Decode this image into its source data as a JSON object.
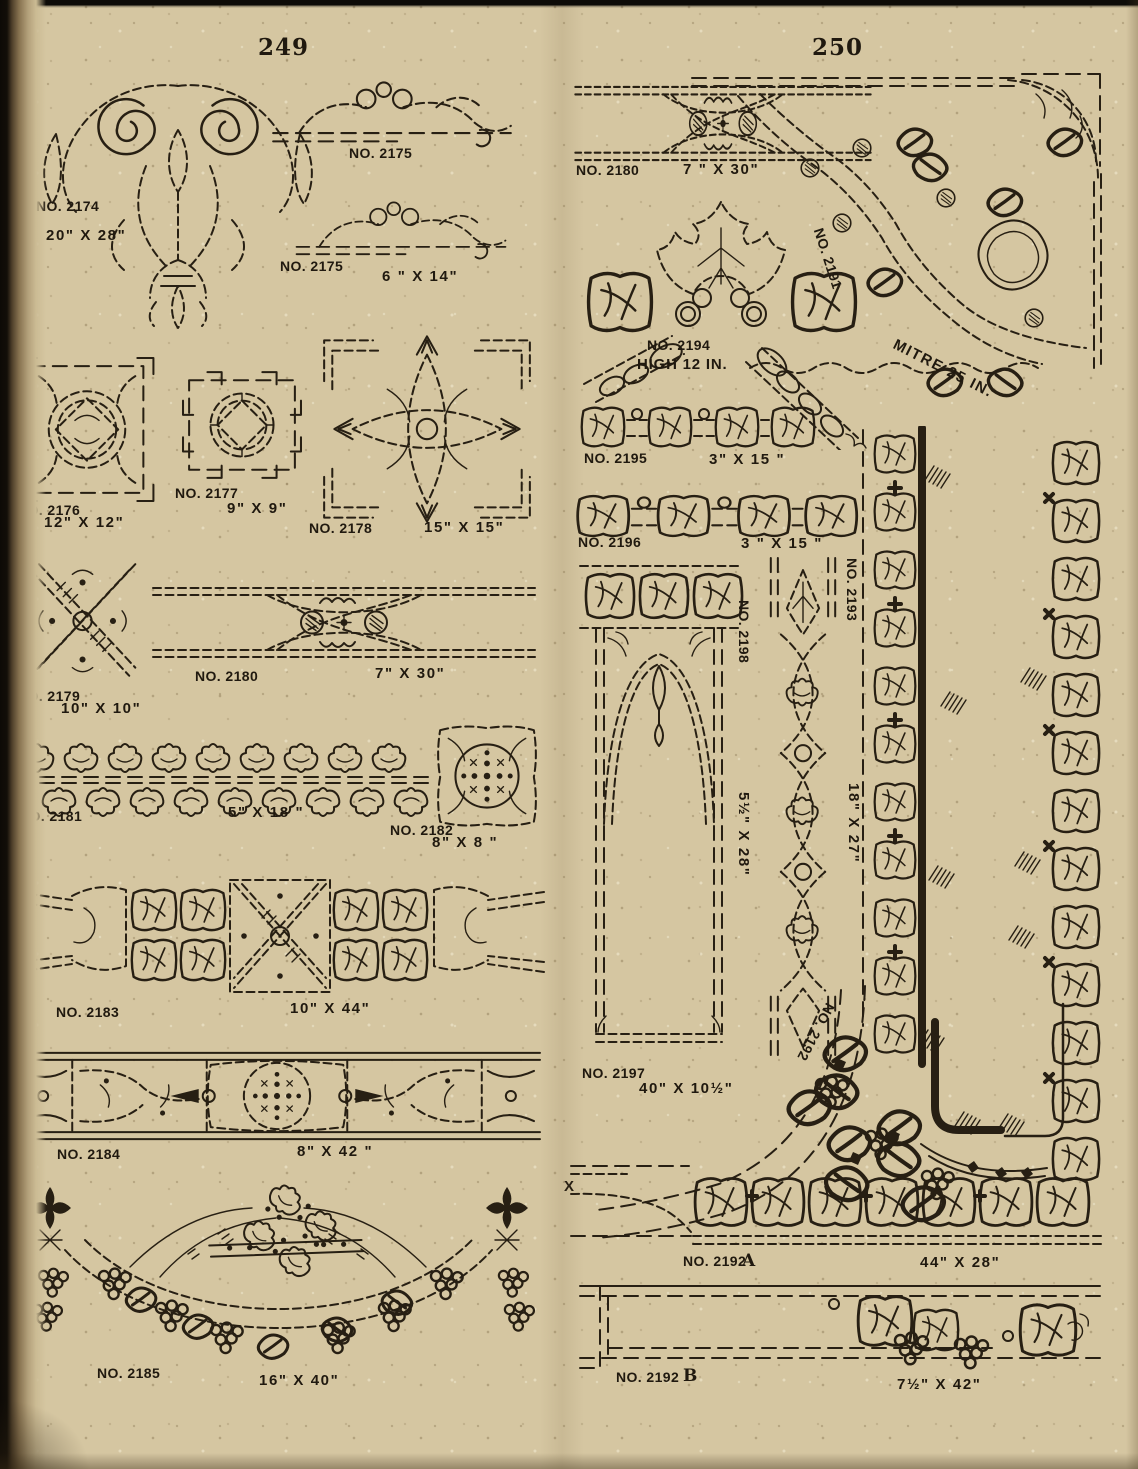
{
  "document": {
    "left_page_number": "249",
    "right_page_number": "250"
  },
  "colors": {
    "paper": "#d5c6a1",
    "ink": "#271f13"
  },
  "left_items": {
    "i2174": {
      "no": "NO. 2174",
      "size": "20\" X 28\""
    },
    "i2175a": {
      "no": "NO. 2175"
    },
    "i2175b": {
      "no": "NO. 2175",
      "size": "6 \" X 14\""
    },
    "i2176": {
      "no": "NO. 2176",
      "size": "12\" X 12\""
    },
    "i2177": {
      "no": "NO. 2177",
      "size": "9\" X  9\""
    },
    "i2178": {
      "no": "NO. 2178",
      "size": "15\" X  15\""
    },
    "i2179": {
      "no": "NO. 2179",
      "size": "10\" X 10\""
    },
    "i2180": {
      "no": "NO. 2180",
      "size": "7\" X 30\""
    },
    "i2181": {
      "no": "NO. 2181",
      "size": "5\" X 18 \""
    },
    "i2182": {
      "no": "NO. 2182",
      "size": "8\" X  8 \""
    },
    "i2183": {
      "no": "NO. 2183",
      "size": "10\" X 44\""
    },
    "i2184": {
      "no": "NO. 2184",
      "size": "8\" X 42 \""
    },
    "i2185": {
      "no": "NO. 2185",
      "size": "16\" X 40\""
    }
  },
  "right_items": {
    "i2180": {
      "no": "NO. 2180",
      "size": "7 \" X 30\""
    },
    "i2191": {
      "no": "NO. 2191",
      "size": "MITRE  25 IN."
    },
    "i2194": {
      "no": "NO. 2194",
      "size": "HIGH 12 IN."
    },
    "i2195": {
      "no": "NO. 2195",
      "size": "3\" X  15 \""
    },
    "i2196": {
      "no": "NO. 2196",
      "size": "3 \" X  15 \""
    },
    "i2197": {
      "no": "NO. 2197",
      "size": "40\" X 10½\""
    },
    "i2198": {
      "no": "NO. 2198",
      "size": "5½\" X 28\""
    },
    "i2193": {
      "no": "NO. 2193",
      "size": "18\" X 27\""
    },
    "i2192a": {
      "no": "NO. 2192",
      "variant": "A",
      "size": "44\" X 28\""
    },
    "i2192b": {
      "no": "NO. 2192",
      "variant": "B",
      "size": "7½\" X 42\""
    },
    "x_marker": "X"
  }
}
